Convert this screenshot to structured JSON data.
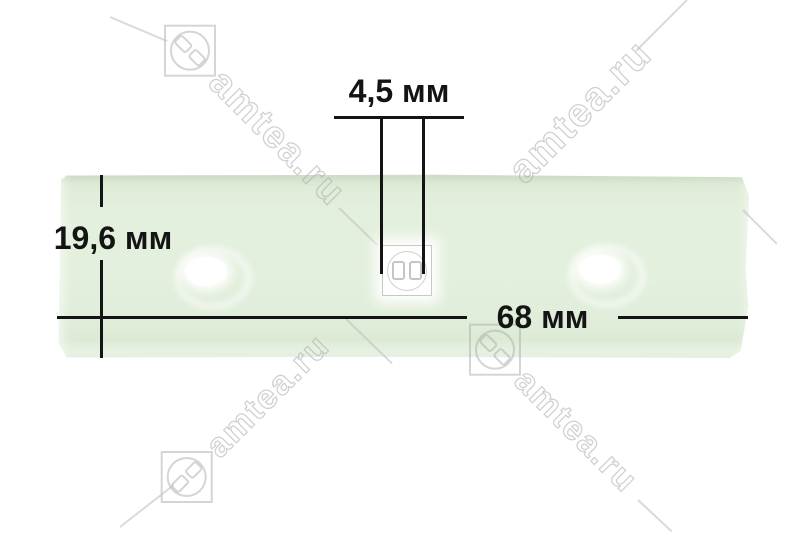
{
  "dimensions": {
    "hole_diameter": {
      "label": "4,5 мм"
    },
    "strip_width": {
      "label": "19,6 мм"
    },
    "strip_length": {
      "label": "68 мм"
    }
  },
  "watermark": {
    "text": "amtea.ru"
  },
  "colors": {
    "background": "#ffffff",
    "strip": "#e4f0de",
    "dimension_line": "#141414",
    "watermark_stroke": "#a8ada8"
  }
}
